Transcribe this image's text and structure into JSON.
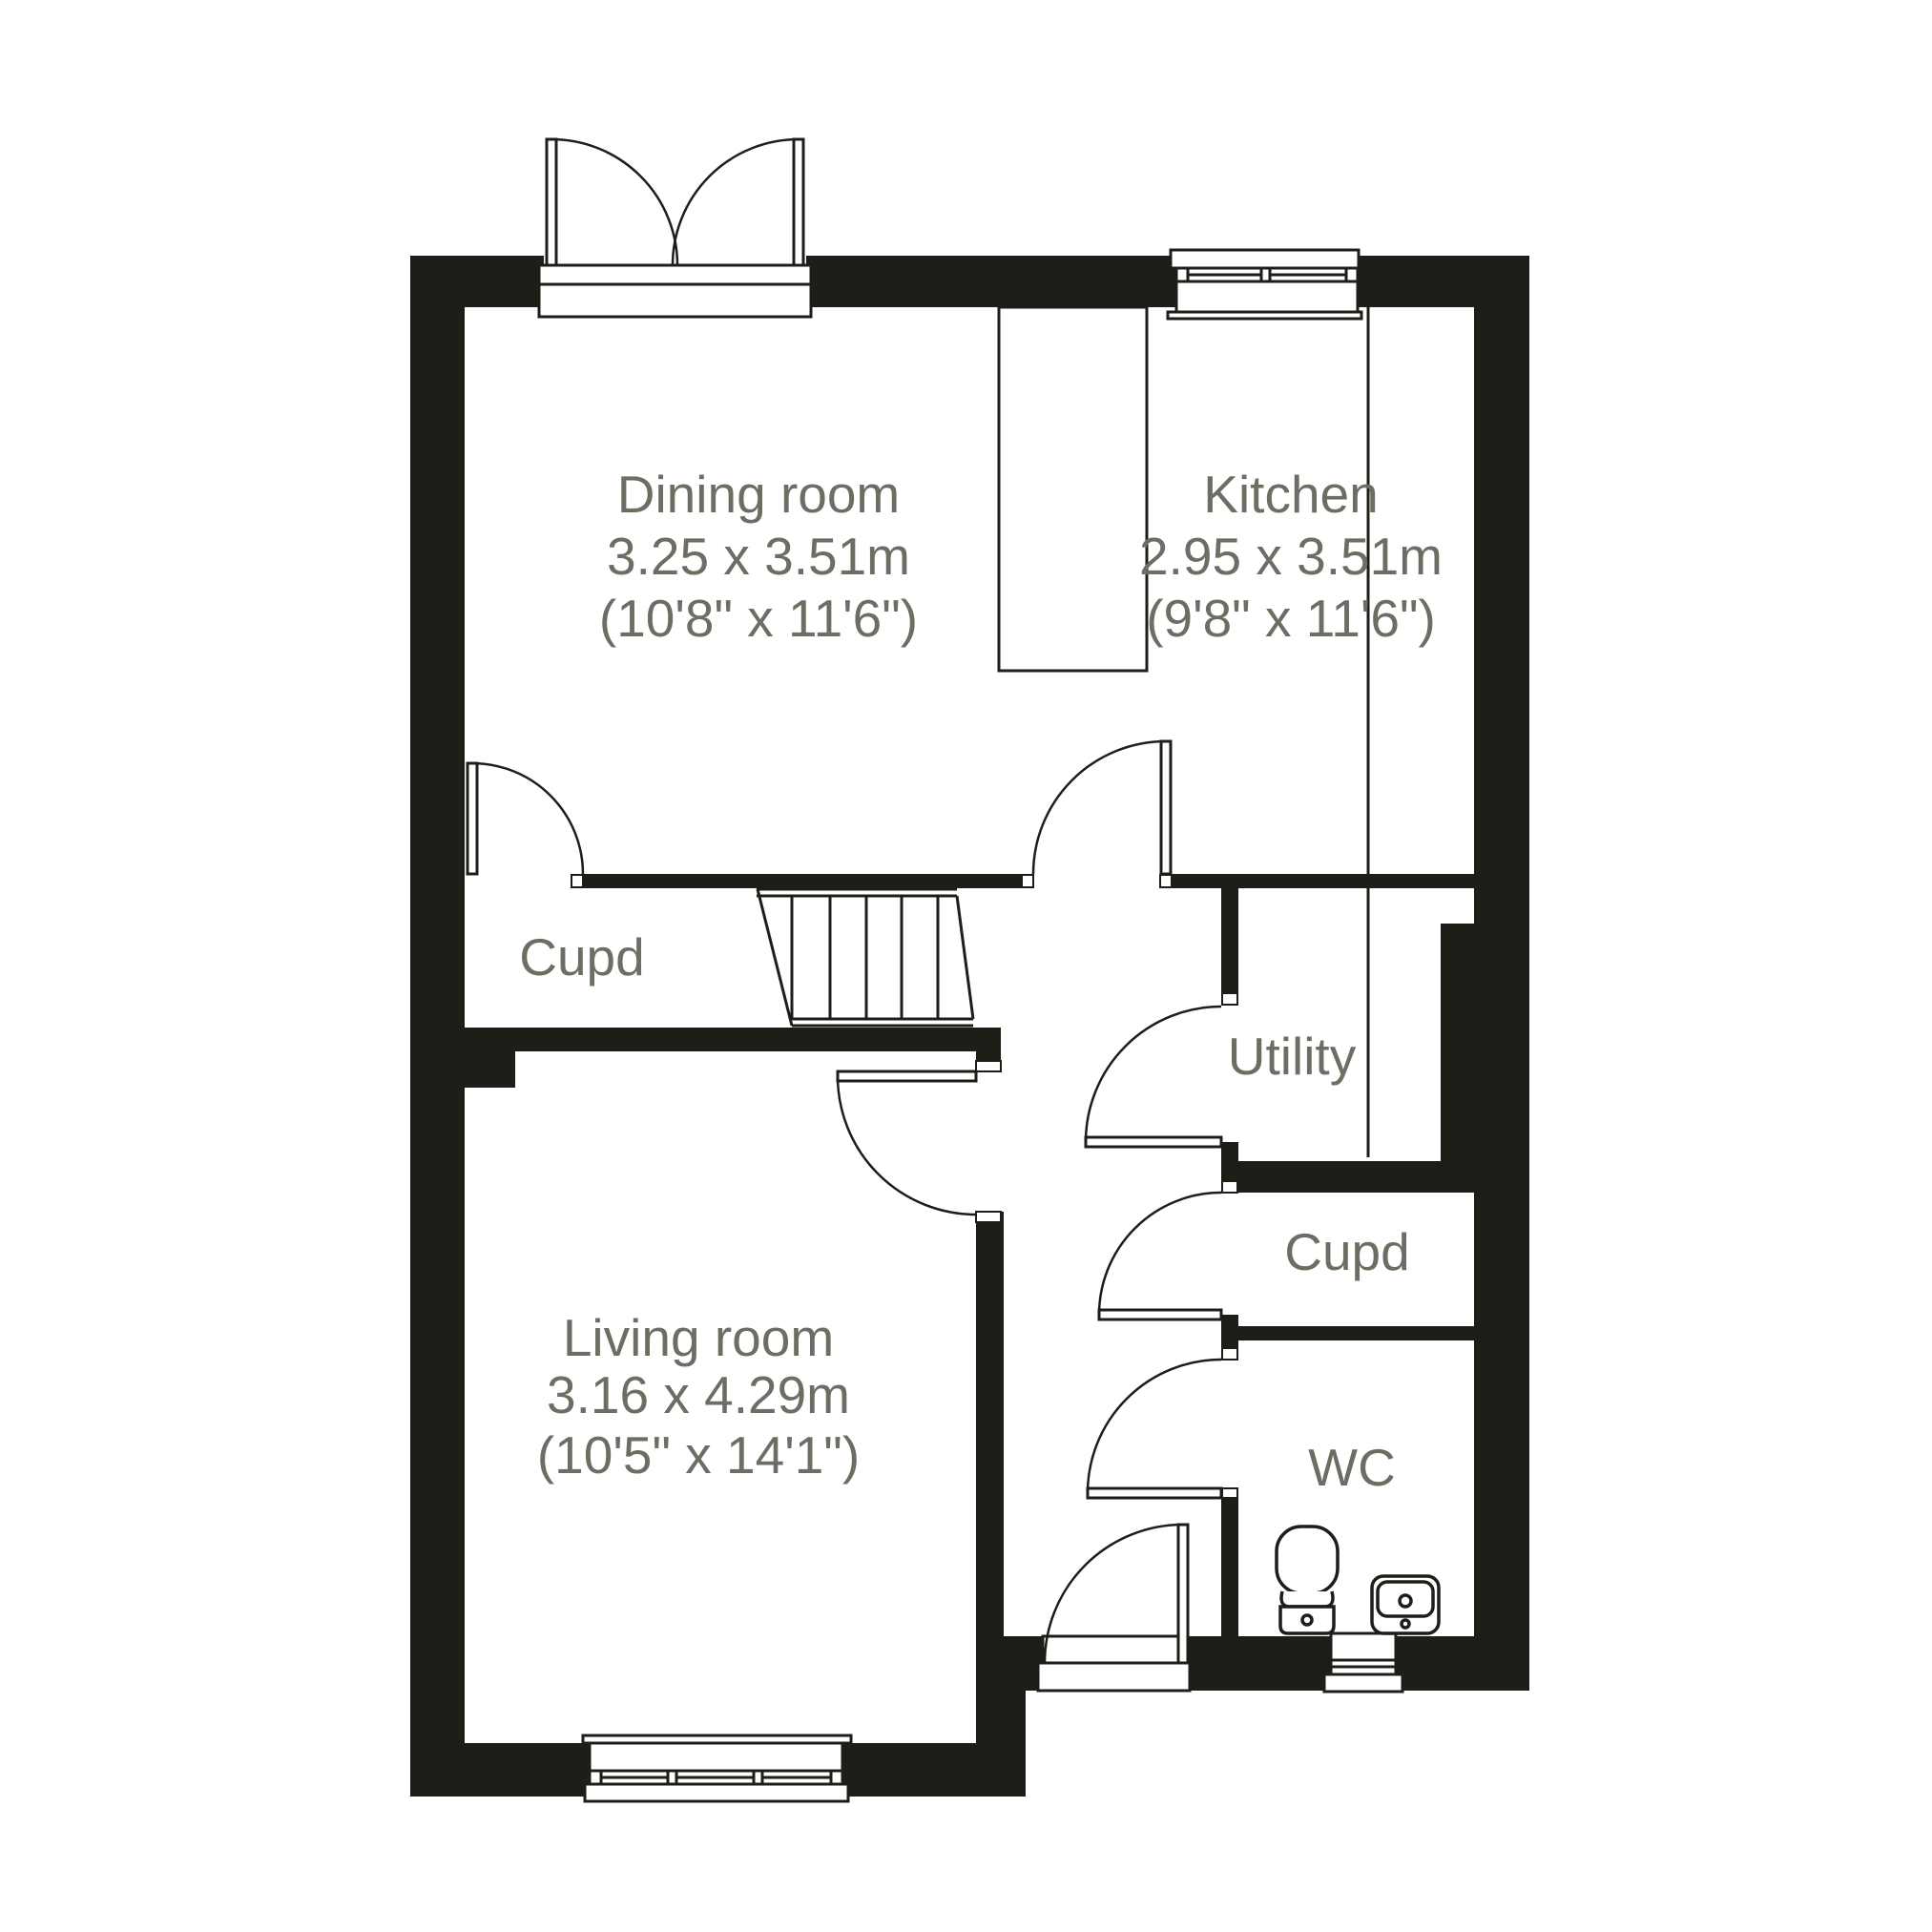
{
  "colors": {
    "wall": "#1f1d18",
    "line": "#1f1d18",
    "label": "#6d6d63",
    "background": "#ffffff"
  },
  "rooms": {
    "dining": {
      "name": "Dining room",
      "dimensions_m": "3.25 x 3.51m",
      "dimensions_ft": "(10'8\" x 11'6\")"
    },
    "kitchen": {
      "name": "Kitchen",
      "dimensions_m": "2.95 x 3.51m",
      "dimensions_ft": "(9'8\" x 11'6\")"
    },
    "living": {
      "name": "Living room",
      "dimensions_m": "3.16 x 4.29m",
      "dimensions_ft": "(10'5\" x 14'1\")"
    },
    "cupboard_understairs": {
      "name": "Cupd"
    },
    "utility": {
      "name": "Utility"
    },
    "cupboard_hall": {
      "name": "Cupd"
    },
    "wc": {
      "name": "WC"
    }
  }
}
